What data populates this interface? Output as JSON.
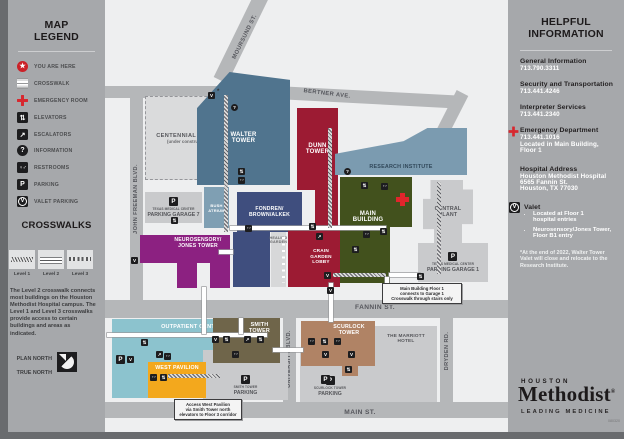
{
  "legend": {
    "title": "MAP\nLEGEND",
    "items": [
      {
        "label": "YOU ARE HERE"
      },
      {
        "label": "CROSSWALK"
      },
      {
        "label": "EMERGENCY ROOM"
      },
      {
        "label": "ELEVATORS"
      },
      {
        "label": "ESCALATORS"
      },
      {
        "label": "INFORMATION"
      },
      {
        "label": "RESTROOMS"
      },
      {
        "label": "PARKING"
      },
      {
        "label": "VALET PARKING"
      }
    ],
    "crosswalks": {
      "title": "CROSSWALKS",
      "levels": [
        "Level 1",
        "Level 2",
        "Level 3"
      ],
      "description": "The Level 2 crosswalk connects most buildings on the Houston Methodist Hospital campus. The Level 1 and Level 3 crosswalks provide access to certain buildings and areas as indicated."
    },
    "north": {
      "plan": "PLAN NORTH",
      "true": "TRUE NORTH"
    }
  },
  "map": {
    "streets": {
      "moursund": "MOURSUND ST.",
      "bertner": "BERTNER AVE.",
      "john_freeman": "JOHN FREEMAN BLVD.",
      "fannin": "FANNIN ST.",
      "university": "UNIVERSITY BLVD.",
      "dryden": "DRYDEN RD.",
      "main": "MAIN ST."
    },
    "buildings": {
      "centennial_name": "CENTENNIAL TOWER",
      "centennial_note": "(under construction)",
      "walter": "WALTER\nTOWER",
      "walter_valet_note": "*",
      "bush": "BUSH\nATRIUM",
      "dunn": "DUNN\nTOWER",
      "research": "RESEARCH INSTITUTE",
      "fondren": "FONDREN/\nBROWN/ALKEK",
      "garage7_sub": "TEXAS MEDICAL CENTER",
      "garage7_name": "PARKING GARAGE 7",
      "neurosensory": "NEUROSENSORY/\nJONES TOWER",
      "healing": "HEALING\nGARDEN",
      "crain": "CRAIN\nGARDEN\nLOBBY",
      "main_building": "MAIN\nBUILDING",
      "central_plant": "CENTRAL\nPLANT",
      "garage1_sub": "TEXAS MEDICAL CENTER",
      "garage1_name": "PARKING GARAGE 1",
      "outpatient": "OUTPATIENT CENTER",
      "west_pavilion": "WEST PAVILION",
      "smith": "SMITH\nTOWER",
      "smith_parking_sub": "SMITH TOWER",
      "smith_parking_name": "PARKING",
      "scurlock": "SCURLOCK\nTOWER",
      "marriott": "THE MARRIOTT\nHOTEL",
      "scurlock_parking_sub": "SCURLOCK TOWER",
      "scurlock_parking_name": "PARKING"
    },
    "callouts": {
      "garage1": "Main Building Floor 1\nconnects to Garage 1\nCrosswalk through stairs only",
      "west_pavilion": "Access West Pavilion\nvia Smith Tower north\nelevators to Floor 3 corridor"
    }
  },
  "info": {
    "title": "HELPFUL\nINFORMATION",
    "entries": [
      {
        "label": "General Information",
        "phone": "713.790.3311"
      },
      {
        "label": "Security and Transportation",
        "phone": "713.441.4246"
      },
      {
        "label": "Interpreter Services",
        "phone": "713.441.2340"
      },
      {
        "label": "Emergency Department",
        "phone": "713.441.1016",
        "note": "Located in Main Building,\nFloor 1"
      },
      {
        "label": "Hospital Address",
        "note": "Houston Methodist Hospital\n6565 Fannin St.\nHouston, TX 77030"
      },
      {
        "label": "Valet",
        "bullets": [
          "Located at Floor 1\nhospital entries",
          "Neurosensory/Jones Tower,\nFloor B1 entry"
        ]
      }
    ],
    "footnote": "*At the end of 2022, Walter Tower Valet will close and relocate to the Research Institute.",
    "logo": {
      "houston": "HOUSTON",
      "methodist": "Methodist",
      "reg": "®",
      "tagline": "LEADING MEDICINE"
    },
    "doc_number": "080320"
  }
}
